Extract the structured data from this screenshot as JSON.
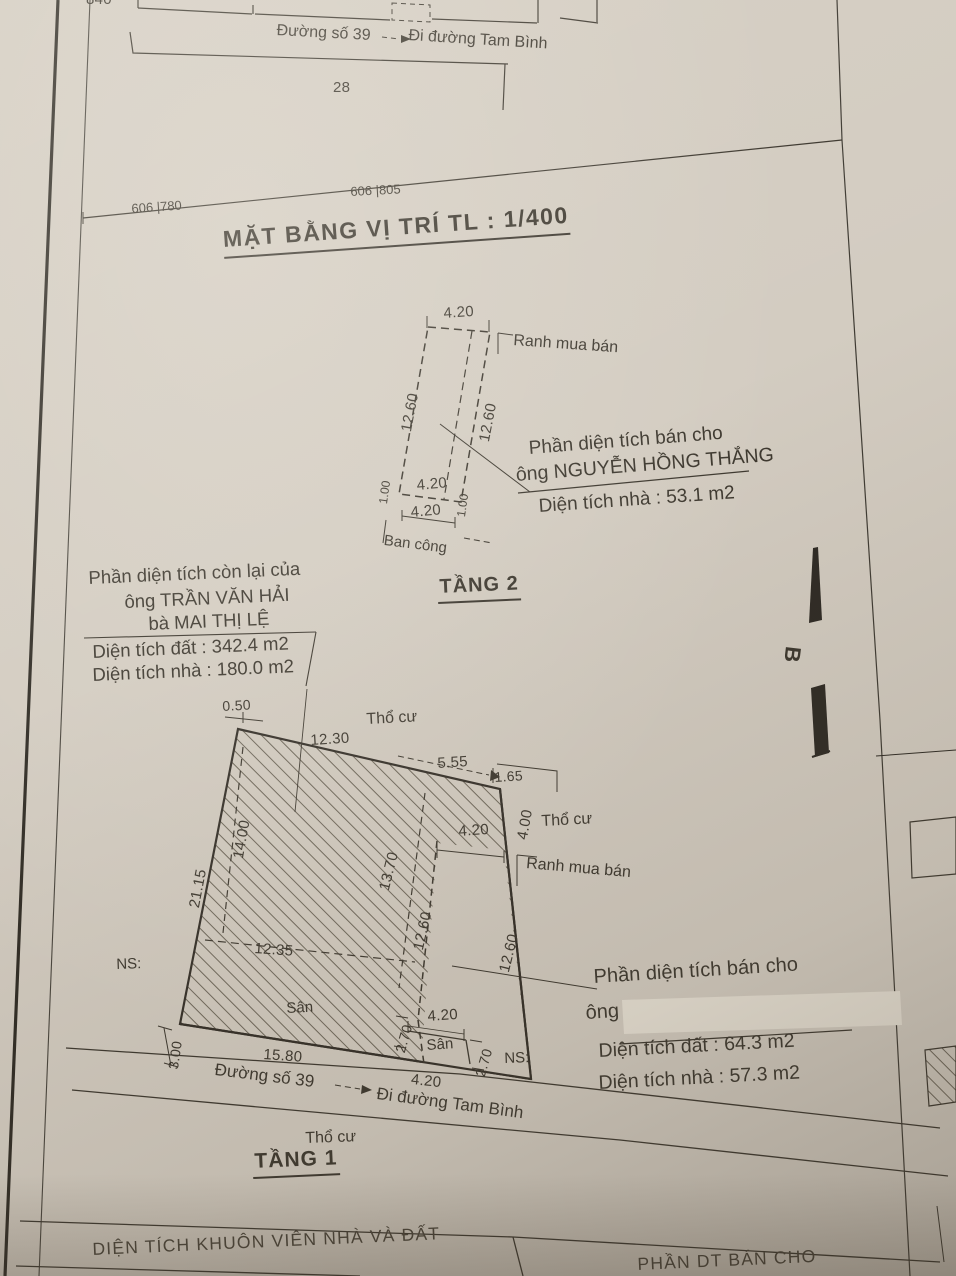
{
  "page": {
    "title": "MẶT BẰNG VỊ TRÍ TL : 1/400",
    "compass_letter": "B"
  },
  "top": {
    "plot_840": "840",
    "plot_28": "28",
    "street": "Đường số 39",
    "street_arrow_dest": "Đi đường Tam Bình",
    "mark_780": "606 |780",
    "mark_805": "606 |805"
  },
  "tang2": {
    "heading": "TẦNG 2",
    "balcony": "Ban công",
    "ranh": "Ranh mua bán",
    "dim_top": "4.20",
    "dim_left": "12.60",
    "dim_inner": "12.60",
    "dim_small_left": "1.00",
    "dim_small_right": "1.00",
    "dim_bottom1": "4.20",
    "dim_bottom2": "4.20",
    "note": {
      "line1": "Phần diện tích bán cho",
      "line2": "ông NGUYỄN HỒNG THẮNG",
      "line3": "Diện tích nhà : 53.1 m2"
    }
  },
  "remaining": {
    "line1": "Phần diện tích còn lại của",
    "line2": "ông TRẦN VĂN HẢI",
    "line3": "bà MAI THỊ LỆ",
    "area_land": "Diện tích đất : 342.4 m2",
    "area_house": "Diện tích nhà : 180.0 m2"
  },
  "tang1": {
    "heading": "TẦNG 1",
    "tho_cu_top": "Thổ cư",
    "tho_cu_right": "Thổ cư",
    "tho_cu_bottom": "Thổ cư",
    "ranh": "Ranh mua bán",
    "san_large": "Sân",
    "san_small": "Sân",
    "ns_left": "NS:",
    "ns_right": "NS:",
    "street": "Đường số 39",
    "street_arrow_dest": "Đi đường Tam Bình",
    "dims": {
      "d050": "0.50",
      "d1230": "12.30",
      "d555": "5.55",
      "d165": "1.65",
      "d400": "4.00",
      "d420_top": "4.20",
      "d1370": "13.70",
      "d1260_inner": "12.60",
      "d1260_right": "12.60",
      "d2115": "21.15",
      "d1400": "14.00",
      "d1235": "12.35",
      "d270_left": "2.70",
      "d420_san": "4.20",
      "d270_right": "2.70",
      "d300": "3.00",
      "d1580": "15.80",
      "d420_road": "4.20"
    },
    "note": {
      "line1": "Phần diện tích bán cho",
      "line2_prefix": "ông",
      "area_land": "Diện tích đất : 64.3 m2",
      "area_house": "Diện tích nhà : 57.3 m2"
    }
  },
  "footer": {
    "left_cell": "DIỆN TÍCH KHUÔN VIÊN NHÀ VÀ ĐẤT",
    "right_cell": "PHẦN DT BÁN CHO"
  }
}
